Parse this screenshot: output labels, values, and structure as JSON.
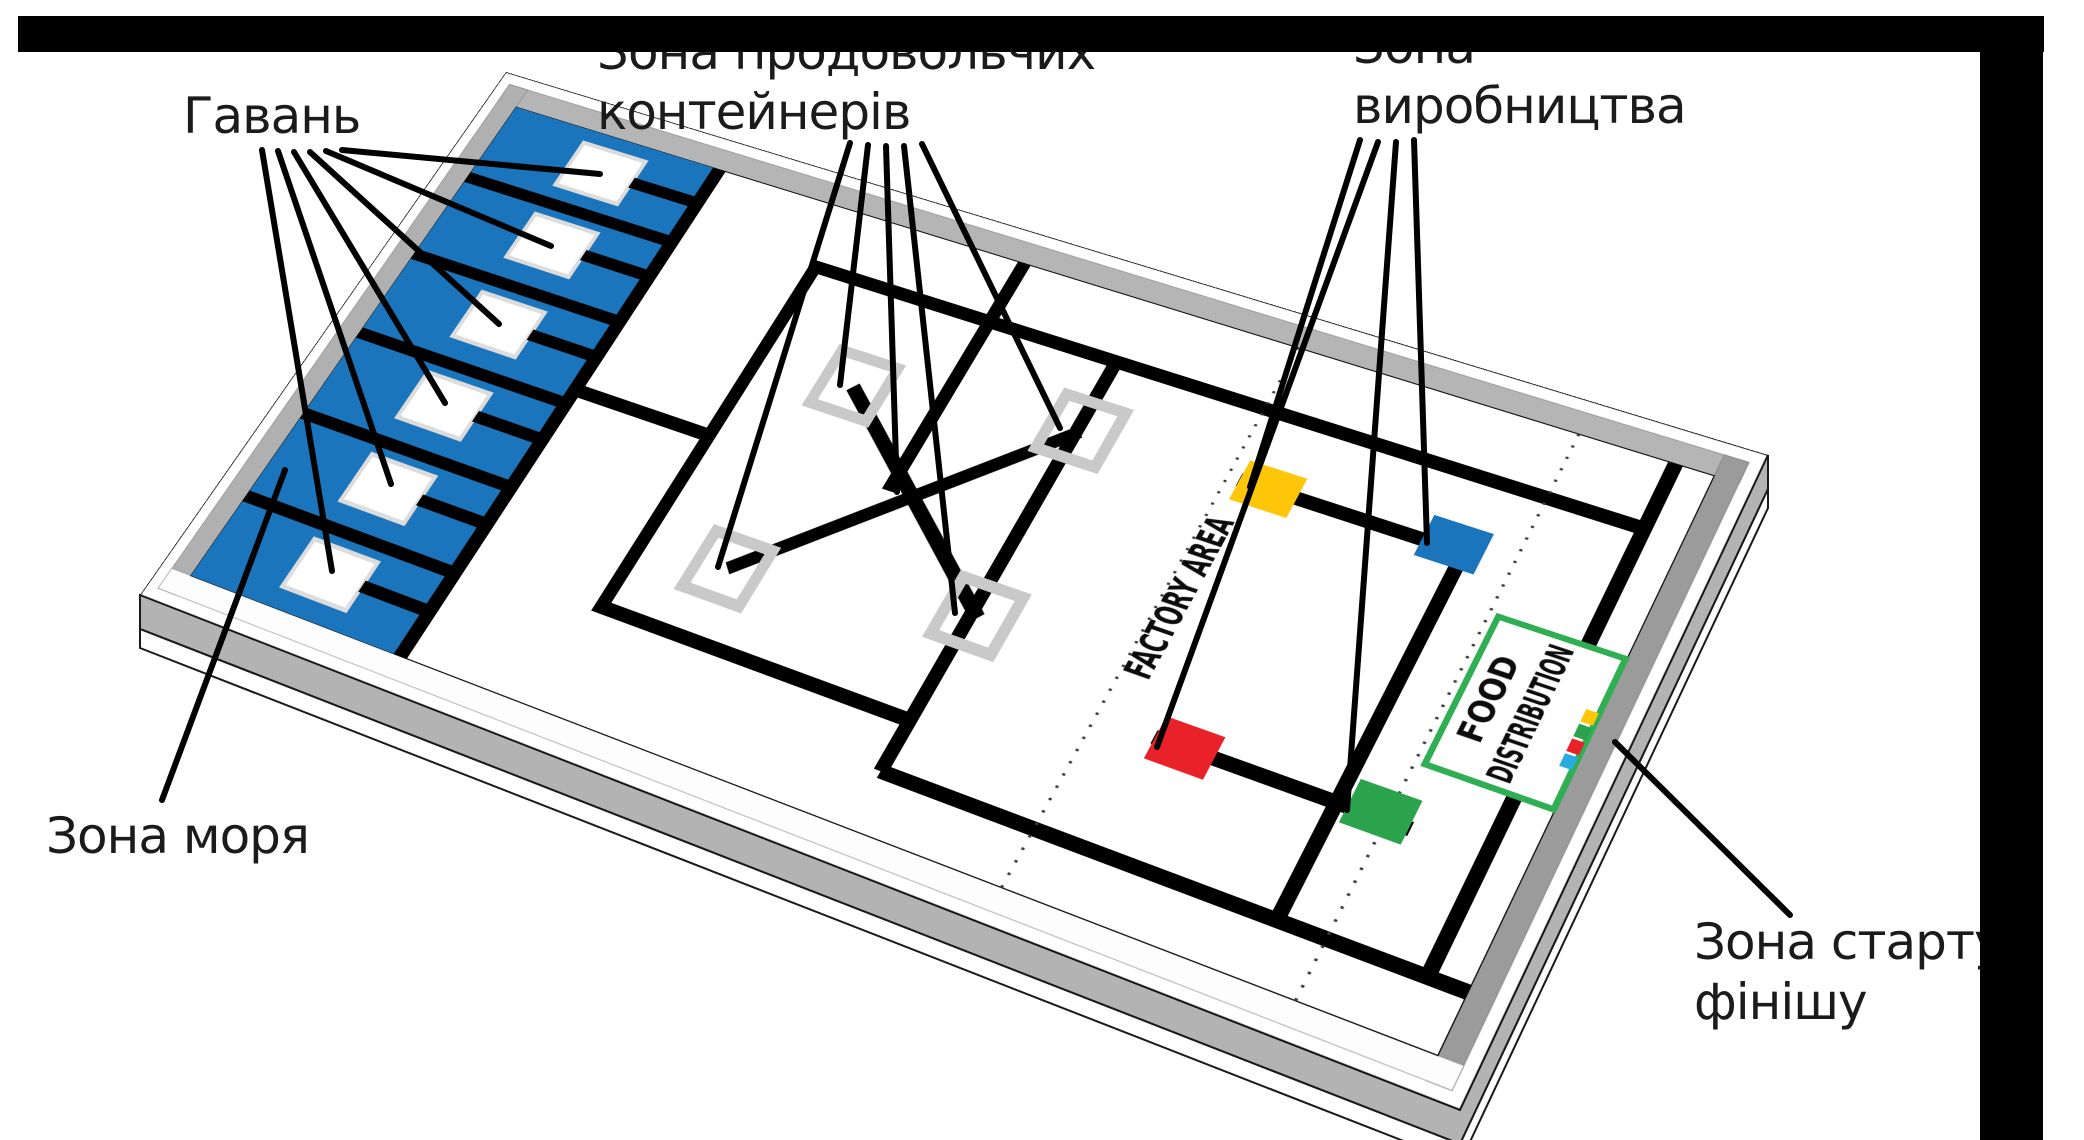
{
  "labels": {
    "harbor": "Гавань",
    "sea": "Зона моря",
    "food_containers": {
      "line1": "Зона продовольчих",
      "line2": "контейнерів"
    },
    "production": {
      "line1": "Зона",
      "line2": "виробництва"
    },
    "start_finish": {
      "line1": "Зона старту",
      "line2": "фінішу"
    }
  },
  "mat": {
    "factory_area_text": "FACTORY AREA",
    "food_zone": {
      "line1": "FOOD",
      "line2": "DISTRIBUTION"
    },
    "wro_logo_icon": "wro-logo"
  },
  "colors": {
    "sea_blue": "#1b75bc",
    "block_yellow": "#fdc608",
    "block_blue": "#1b75bc",
    "block_red": "#e92128",
    "block_green": "#2ba24c",
    "food_zone_border": "#2fae54",
    "container_marker_gray": "#c9c9c9",
    "wall_gray": "#b5b5b5",
    "crop_bar": "#000000"
  },
  "counts": {
    "harbor_docks": 6,
    "sea_cells": 6,
    "container_markers": 4,
    "production_blocks": 4,
    "harbor_pointer_lines": 6,
    "container_pointer_lines": 5,
    "production_pointer_lines": 4
  }
}
